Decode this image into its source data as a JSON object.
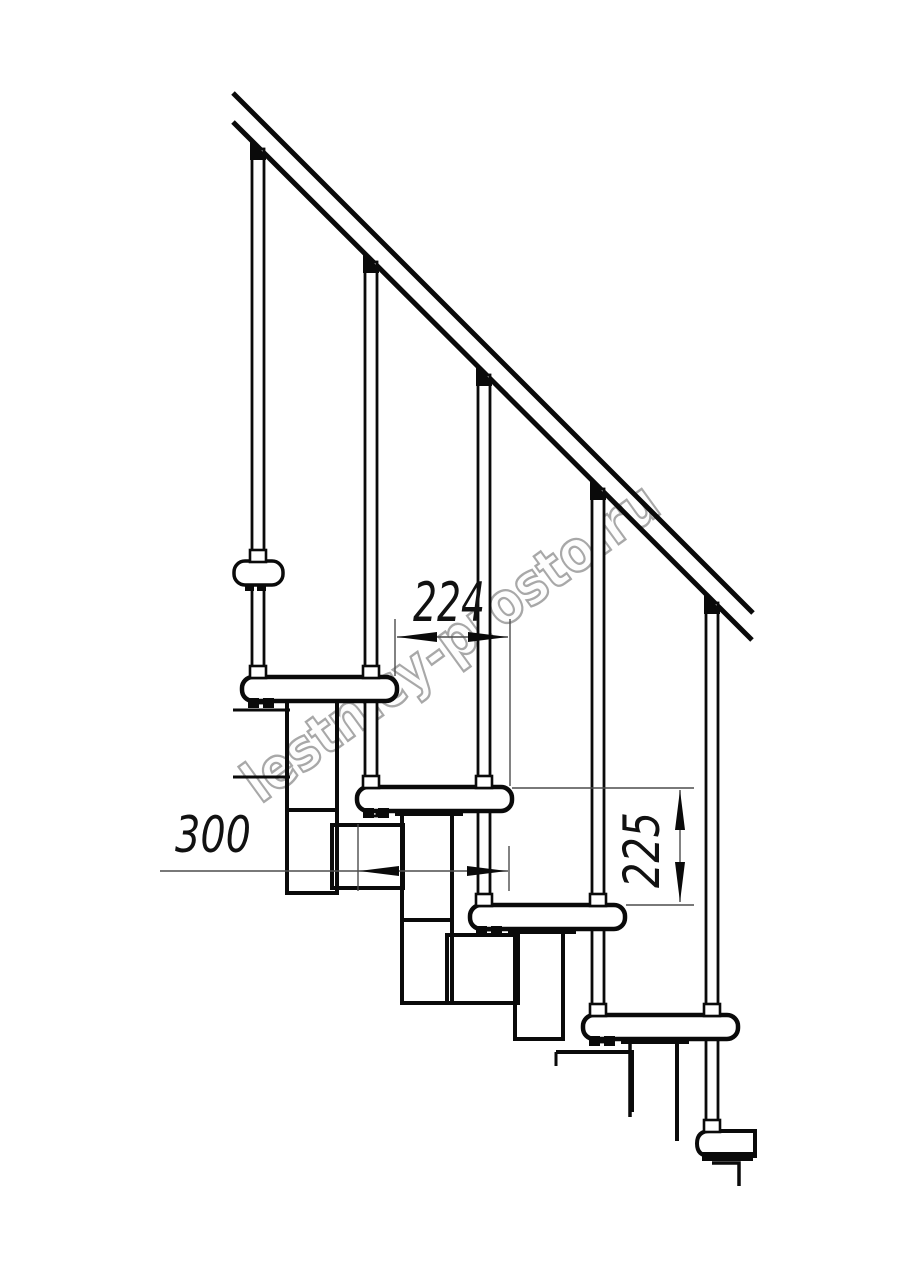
{
  "watermark": {
    "text": "lestnicy-prosto.ru"
  },
  "dimensions": {
    "going_horizontal": "224",
    "tread_depth": "300",
    "riser_height": "225"
  },
  "colors": {
    "line": "#0a0a0a",
    "dim_line": "#4d4d4d",
    "watermark_outline": "#a8a8a8",
    "background": "#ffffff"
  }
}
